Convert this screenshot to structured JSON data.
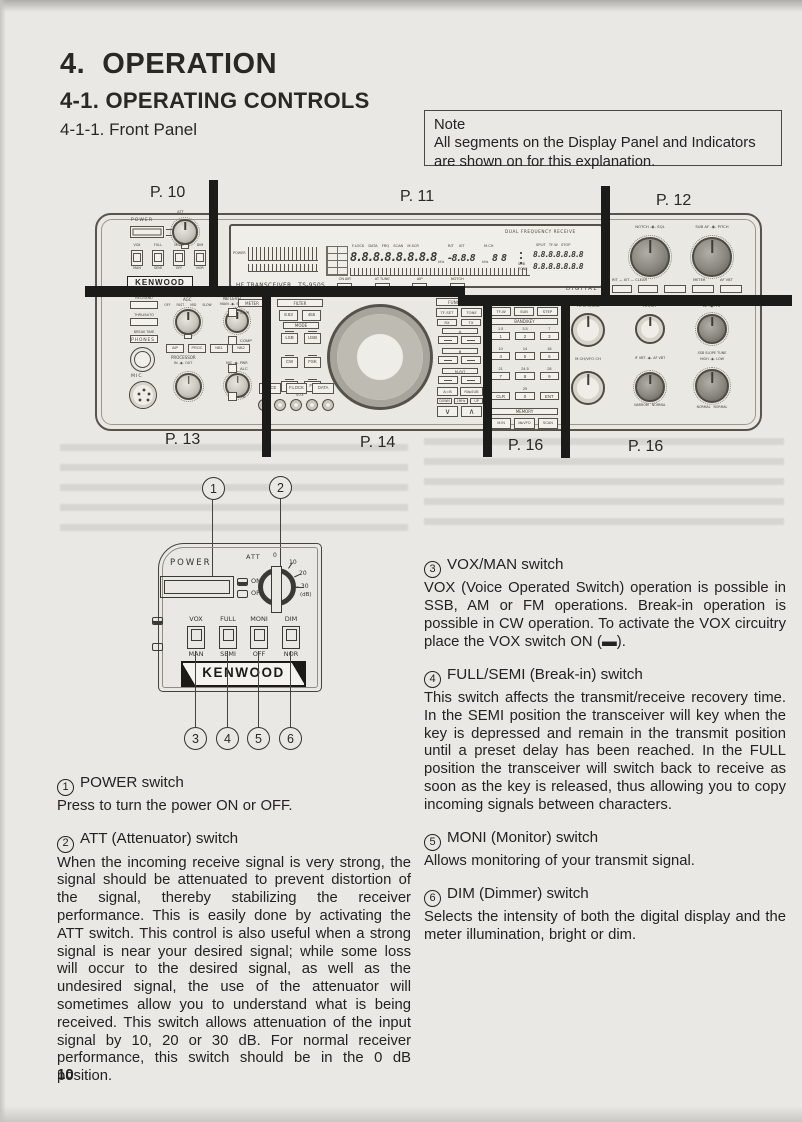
{
  "page": {
    "section_title": "4.  OPERATION",
    "subsection_title": "4-1. OPERATING CONTROLS",
    "subsubsection_title": "4-1-1. Front Panel",
    "page_number": "10",
    "note": {
      "title": "Note",
      "body": "All segments on the Display Panel and Indicators are shown on for this explanation."
    }
  },
  "front_panel": {
    "page_refs_top": [
      "P. 10",
      "P. 11",
      "P. 12"
    ],
    "page_refs_bottom": [
      "P. 13",
      "P. 14",
      "P. 16",
      "P. 16"
    ],
    "power_block": {
      "power_label": "POWER",
      "att_label": "ATT",
      "switches": [
        {
          "top": "VOX",
          "bottom": "MAN"
        },
        {
          "top": "FULL",
          "bottom": "SEMI"
        },
        {
          "top": "MONI",
          "bottom": "OFF"
        },
        {
          "top": "DIM",
          "bottom": "NOR"
        }
      ],
      "brand": "KENWOOD"
    },
    "display": {
      "dual_freq_label": "DUAL FREQUENCY RECEIVE",
      "meter_label": "POWER",
      "status_labels": "F.LOCK DATA FRQ SCAN M.SCR",
      "rit_xit_labels": "RIT XIT",
      "mch_label": "M.CH",
      "main_digits": "8.8.8.8.8.8.8.8",
      "khz_label": "kHz",
      "rit_digits": "-8.8.8",
      "khz_label_2": "kHz",
      "ch_digits": "8 8",
      "split_labels": "SPLIT TF-W STOP",
      "sub_digits_top": "8.8.8.8.8.8.8",
      "sub_digits_bottom": "8.8.8.8.8.8.8",
      "sub_tone_label": "SUB\nTONE",
      "model_text": "HF TRANSCEIVER   TS-950S",
      "digital_label": "DIGITAL",
      "indicators": [
        {
          "label": "ON AIR"
        },
        {
          "label": "AT TUNE"
        },
        {
          "label": "AIP"
        },
        {
          "label": "NOTCH"
        }
      ]
    },
    "notch_sql_block": {
      "knob1_label": "NOTCH -◉- SQL",
      "knob2_label": "SUB AF -◉- PITCH",
      "buttons_label_1": "RIT — XIT — CLEAR",
      "buttons_label_2": "METER",
      "buttons_label_3": "AF VBT"
    },
    "lower_left": {
      "stack_buttons": [
        {
          "label": "REC/SEND"
        },
        {
          "label": "THRU/AUTO"
        },
        {
          "label": "BREAK TIME"
        }
      ],
      "phones_label": "PHONES",
      "mic_label": "MIC",
      "agc_label": "AGC",
      "agc_positions": "OFF FAST MID SLOW",
      "nb_label": "NB LEVEL",
      "nb_sub_label": "MAIN -◉- SUB",
      "small_buttons": [
        {
          "label": "AIP"
        },
        {
          "label": "PROC"
        },
        {
          "label": "NB1"
        },
        {
          "label": "NB2"
        }
      ],
      "processor_label": "PROCESSOR",
      "processor_sub_label": "IN -◉- OUT",
      "mic_pwr_label": "MIC -◉- PWR"
    },
    "center": {
      "meter_header": "METER",
      "filter_header": "FILTER",
      "meter_buttons": [
        {
          "label": "SWR"
        },
        {
          "label": "COMP"
        },
        {
          "label": "ALC"
        },
        {
          "label": "TX"
        }
      ],
      "filter_buttons": [
        {
          "label": "8.83"
        },
        {
          "label": "455"
        }
      ],
      "mode_header": "MODE",
      "mode_buttons": [
        {
          "label": "LSB"
        },
        {
          "label": "USB"
        },
        {
          "label": "CW"
        },
        {
          "label": "FSK"
        },
        {
          "label": "AM"
        },
        {
          "label": "FM"
        }
      ],
      "bottom_buttons": [
        {
          "label": "VOICE"
        },
        {
          "label": "F.LOCK"
        },
        {
          "label": "DATA"
        }
      ],
      "vox_row_label": "VOX"
    },
    "function_block": {
      "header": "FUNCTION",
      "btn_tf_set": "TF-SET",
      "btn_tone": "TONE",
      "rx_label": "RX",
      "tx_label": "TX",
      "group_a": "A",
      "group_b": "B",
      "group_mrit": "M.RIT",
      "btn_aeqb": "A=B",
      "btn_rxsub": "RX▸SUB",
      "down_label": "DOWN",
      "mid_label": "1MHz",
      "up_label": "UP"
    },
    "keypad_block": {
      "header": "TX VFO/SUB",
      "btn_tfw": "TF-W",
      "btn_sub": "SUB",
      "btn_step": "STEP",
      "bandkey_header": "BAND/KEY",
      "keys": [
        {
          "band": "1.5",
          "key": "1"
        },
        {
          "band": "3.5",
          "key": "2"
        },
        {
          "band": "7",
          "key": "3"
        },
        {
          "band": "10",
          "key": "4"
        },
        {
          "band": "14",
          "key": "5"
        },
        {
          "band": "18",
          "key": "6"
        },
        {
          "band": "21",
          "key": "7"
        },
        {
          "band": "24.5",
          "key": "8"
        },
        {
          "band": "28",
          "key": "9"
        },
        {
          "band": "",
          "key": "CLR"
        },
        {
          "band": "29",
          "key": "0"
        },
        {
          "band": "",
          "key": "ENT"
        }
      ],
      "memory_header": "MEMORY",
      "memory_buttons": [
        {
          "label": "M.IN"
        },
        {
          "label": "M▸VFO"
        },
        {
          "label": "SCAN"
        }
      ]
    },
    "lower_right": {
      "knob1_label": "TX VFO/SUB",
      "knob2_label": "RIT/XIT",
      "knob3_label": "AF -◉- RF",
      "knob4_label": "M.CH/VFO CH",
      "knob5_label": "IF VBT -◉- AF VBT",
      "knob5_sub": "NARROW   NORMAL",
      "knob6_label": "SSB SLOPE TUNE",
      "knob6_sub": "HIGH -◉- LOW",
      "knob6_bottom": "NORMAL   NORMAL"
    }
  },
  "detail_panel": {
    "power_label": "POWER",
    "att_label": "ATT",
    "scale_0": "0",
    "scale_10": "10",
    "scale_20": "20",
    "scale_30": "– 30",
    "scale_db": "(dB)",
    "on_label": "ON",
    "off_label": "OFF",
    "switches": [
      {
        "top": "VOX",
        "bottom": "MAN"
      },
      {
        "top": "FULL",
        "bottom": "SEMI"
      },
      {
        "top": "MONI",
        "bottom": "OFF"
      },
      {
        "top": "DIM",
        "bottom": "NOR"
      }
    ],
    "brand": "KENWOOD",
    "callouts": [
      "1",
      "2",
      "3",
      "4",
      "5",
      "6"
    ]
  },
  "sections_left": [
    {
      "num": "1",
      "title": "POWER switch",
      "body": "Press to turn the power ON or OFF."
    },
    {
      "num": "2",
      "title": "ATT (Attenuator) switch",
      "body": "When the incoming receive signal is very strong, the signal should be attenuated to prevent distortion of the signal, thereby stabilizing the receiver performance. This is easily done by activating the ATT switch. This control is also useful when a strong signal is near your desired signal; while some loss will occur to the desired signal, as well as the undesired signal, the use of the attenuator will sometimes allow you to understand what is being received. This switch allows attenuation of the input signal by 10, 20 or 30 dB. For normal receiver performance, this switch should be in the 0 dB position."
    }
  ],
  "sections_right": [
    {
      "num": "3",
      "title": "VOX/MAN switch",
      "body": "VOX (Voice Operated Switch) operation is possible in SSB, AM or FM operations. Break-in operation is possible in CW operation. To activate the VOX circuitry place the VOX switch ON (▬)."
    },
    {
      "num": "4",
      "title": "FULL/SEMI (Break-in) switch",
      "body": "This switch affects the transmit/receive recovery time. In the SEMI position the transceiver will key when the key is depressed and remain in the transmit position until a preset delay has been reached. In the FULL position the transceiver will switch back to receive as soon as the key is released, thus allowing you to copy incoming signals between characters."
    },
    {
      "num": "5",
      "title": "MONI (Monitor) switch",
      "body": "Allows monitoring of your transmit signal."
    },
    {
      "num": "6",
      "title": "DIM (Dimmer) switch",
      "body": "Selects the intensity of both the digital display and the meter illumination, bright or dim."
    }
  ]
}
